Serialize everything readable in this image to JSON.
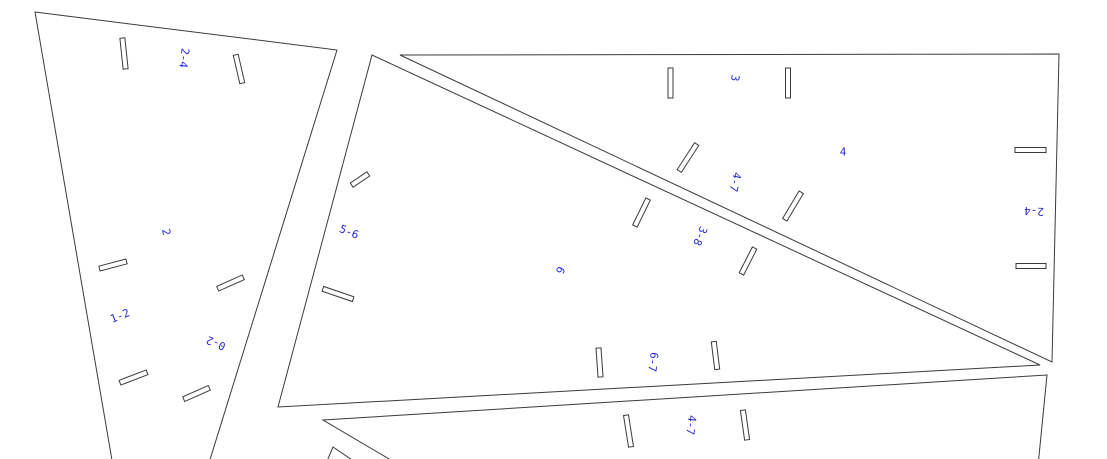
{
  "canvas": {
    "width": 1107,
    "height": 459,
    "background_color": "#ffffff",
    "line_color": "#3b3b3b",
    "label_color": "#2a2ad8"
  },
  "panels": [
    {
      "name": "panel-A",
      "points": [
        [
          35,
          12
        ],
        [
          337,
          50
        ],
        [
          208,
          466
        ],
        [
          113,
          466
        ]
      ]
    },
    {
      "name": "panel-B",
      "points": [
        [
          372,
          55
        ],
        [
          1040,
          365
        ],
        [
          278,
          407
        ]
      ]
    },
    {
      "name": "panel-C",
      "points": [
        [
          400,
          55
        ],
        [
          1059,
          54
        ],
        [
          1052,
          362
        ]
      ]
    },
    {
      "name": "panel-D",
      "points": [
        [
          323,
          420
        ],
        [
          1047,
          375
        ],
        [
          1038,
          466
        ],
        [
          401,
          466
        ]
      ]
    },
    {
      "name": "panel-E",
      "points": [
        [
          333,
          447
        ],
        [
          325,
          466
        ],
        [
          361,
          466
        ]
      ]
    }
  ],
  "slots": [
    {
      "cx": 124,
      "cy": 53.5,
      "length": 31,
      "width": 5,
      "angle": 84
    },
    {
      "cx": 239,
      "cy": 69,
      "length": 29,
      "width": 5,
      "angle": 77
    },
    {
      "cx": 113,
      "cy": 265,
      "length": 28,
      "width": 5,
      "angle": -15
    },
    {
      "cx": 230.5,
      "cy": 283,
      "length": 28,
      "width": 5,
      "angle": -24
    },
    {
      "cx": 133.5,
      "cy": 377.5,
      "length": 29,
      "width": 5,
      "angle": -21
    },
    {
      "cx": 196.5,
      "cy": 393.5,
      "length": 28,
      "width": 5,
      "angle": -24
    },
    {
      "cx": 360,
      "cy": 179.5,
      "length": 20,
      "width": 5,
      "angle": -34
    },
    {
      "cx": 338,
      "cy": 294,
      "length": 32,
      "width": 5,
      "angle": 19
    },
    {
      "cx": 641.5,
      "cy": 212.5,
      "length": 30,
      "width": 5,
      "angle": -64
    },
    {
      "cx": 748,
      "cy": 261,
      "length": 29,
      "width": 5,
      "angle": -63
    },
    {
      "cx": 599.5,
      "cy": 362.5,
      "length": 29,
      "width": 5,
      "angle": 86
    },
    {
      "cx": 715.5,
      "cy": 355.5,
      "length": 28,
      "width": 5,
      "angle": 83
    },
    {
      "cx": 670.5,
      "cy": 83,
      "length": 30,
      "width": 5,
      "angle": 90
    },
    {
      "cx": 788,
      "cy": 83,
      "length": 30,
      "width": 5,
      "angle": 90
    },
    {
      "cx": 688,
      "cy": 157.5,
      "length": 32,
      "width": 5,
      "angle": -57
    },
    {
      "cx": 793,
      "cy": 206,
      "length": 32,
      "width": 5,
      "angle": -59
    },
    {
      "cx": 1030.5,
      "cy": 150,
      "length": 31,
      "width": 5,
      "angle": 0
    },
    {
      "cx": 1031,
      "cy": 266,
      "length": 30,
      "width": 5,
      "angle": 0
    },
    {
      "cx": 628.5,
      "cy": 431,
      "length": 32,
      "width": 5,
      "angle": 81
    },
    {
      "cx": 745,
      "cy": 425,
      "length": 30,
      "width": 5,
      "angle": 82
    }
  ],
  "labels": [
    {
      "text": "2-4",
      "x": 184,
      "y": 58,
      "angle": 97
    },
    {
      "text": "2",
      "x": 166,
      "y": 232,
      "angle": 80
    },
    {
      "text": "1-2",
      "x": 120,
      "y": 316,
      "angle": -22
    },
    {
      "text": "0-2",
      "x": 216,
      "y": 343,
      "angle": 203
    },
    {
      "text": "5-6",
      "x": 349,
      "y": 232,
      "angle": 22
    },
    {
      "text": "6",
      "x": 560,
      "y": 270,
      "angle": 113
    },
    {
      "text": "3-8",
      "x": 700,
      "y": 236,
      "angle": 113
    },
    {
      "text": "6-7",
      "x": 653,
      "y": 362,
      "angle": 97
    },
    {
      "text": "3",
      "x": 735,
      "y": 78,
      "angle": 97
    },
    {
      "text": "4",
      "x": 843,
      "y": 152,
      "angle": 0
    },
    {
      "text": "4-7",
      "x": 735,
      "y": 182,
      "angle": 103
    },
    {
      "text": "2-4",
      "x": 1034,
      "y": 211,
      "angle": 183
    },
    {
      "text": "4-7",
      "x": 691,
      "y": 425,
      "angle": 97
    }
  ]
}
